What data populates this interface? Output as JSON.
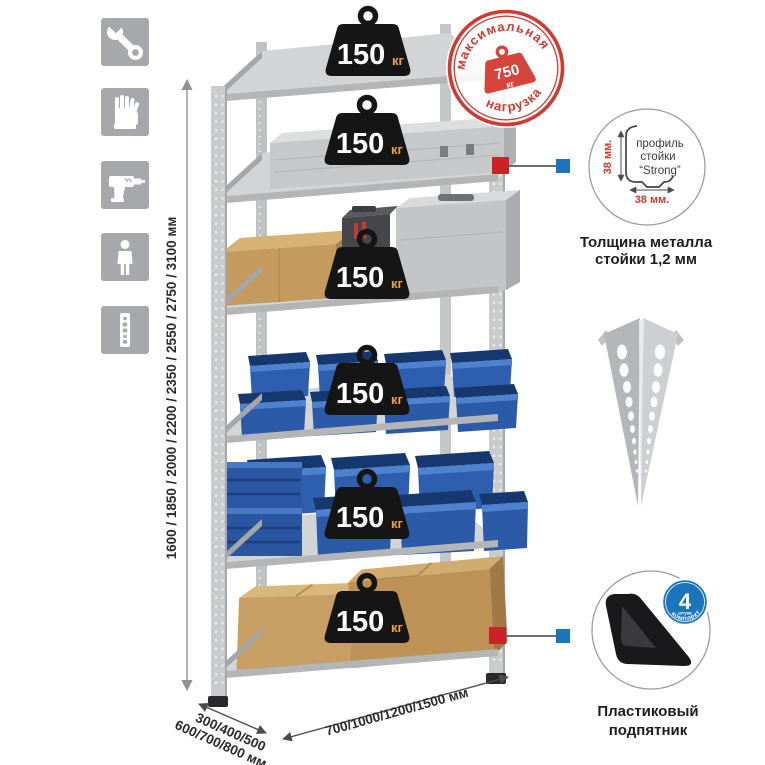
{
  "sidebar_icons": [
    "wrench",
    "gloves",
    "drill",
    "person",
    "rack-post-profile"
  ],
  "dimensions": {
    "height": "1600 / 1850 / 2000 / 2200 / 2350 / 2550 / 2750 / 3100 мм",
    "depth_line1": "300/400/500",
    "depth_line2": "600/700/800 мм",
    "width": "700/1000/1200/1500 мм"
  },
  "rack": {
    "badges": [
      {
        "value": "150",
        "unit": "кг"
      },
      {
        "value": "150",
        "unit": "кг"
      },
      {
        "value": "150",
        "unit": "кг"
      },
      {
        "value": "150",
        "unit": "кг"
      },
      {
        "value": "150",
        "unit": "кг"
      },
      {
        "value": "150",
        "unit": "кг"
      }
    ]
  },
  "stamp": {
    "arc_top": "максимальная",
    "arc_bottom": "нагрузка",
    "value": "750",
    "unit": "кг"
  },
  "details": {
    "profile": {
      "line1": "профиль",
      "line2": "стойки",
      "line3": "“Strong”",
      "dim_vertical": "38 мм.",
      "dim_horizontal": "38 мм.",
      "caption_line1": "Толщина металла",
      "caption_line2": "стойки 1,2 мм"
    },
    "foot": {
      "badge_value": "4",
      "badge_sub": "штуки",
      "badge_arc": "в комплекте",
      "caption_line1": "Пластиковый",
      "caption_line2": "подпятник"
    }
  },
  "colors": {
    "accent_red": "#cc2127",
    "accent_blue": "#1c75bc",
    "stamp_red": "#cf3a33",
    "badge_black": "#151515",
    "badge_unit_orange": "#f59e31",
    "bin_blue": "#2e5fae",
    "steel_gray": "#c9cbcd",
    "cardboard_tan": "#c49a5f",
    "icon_gray": "#a6a8ab"
  }
}
